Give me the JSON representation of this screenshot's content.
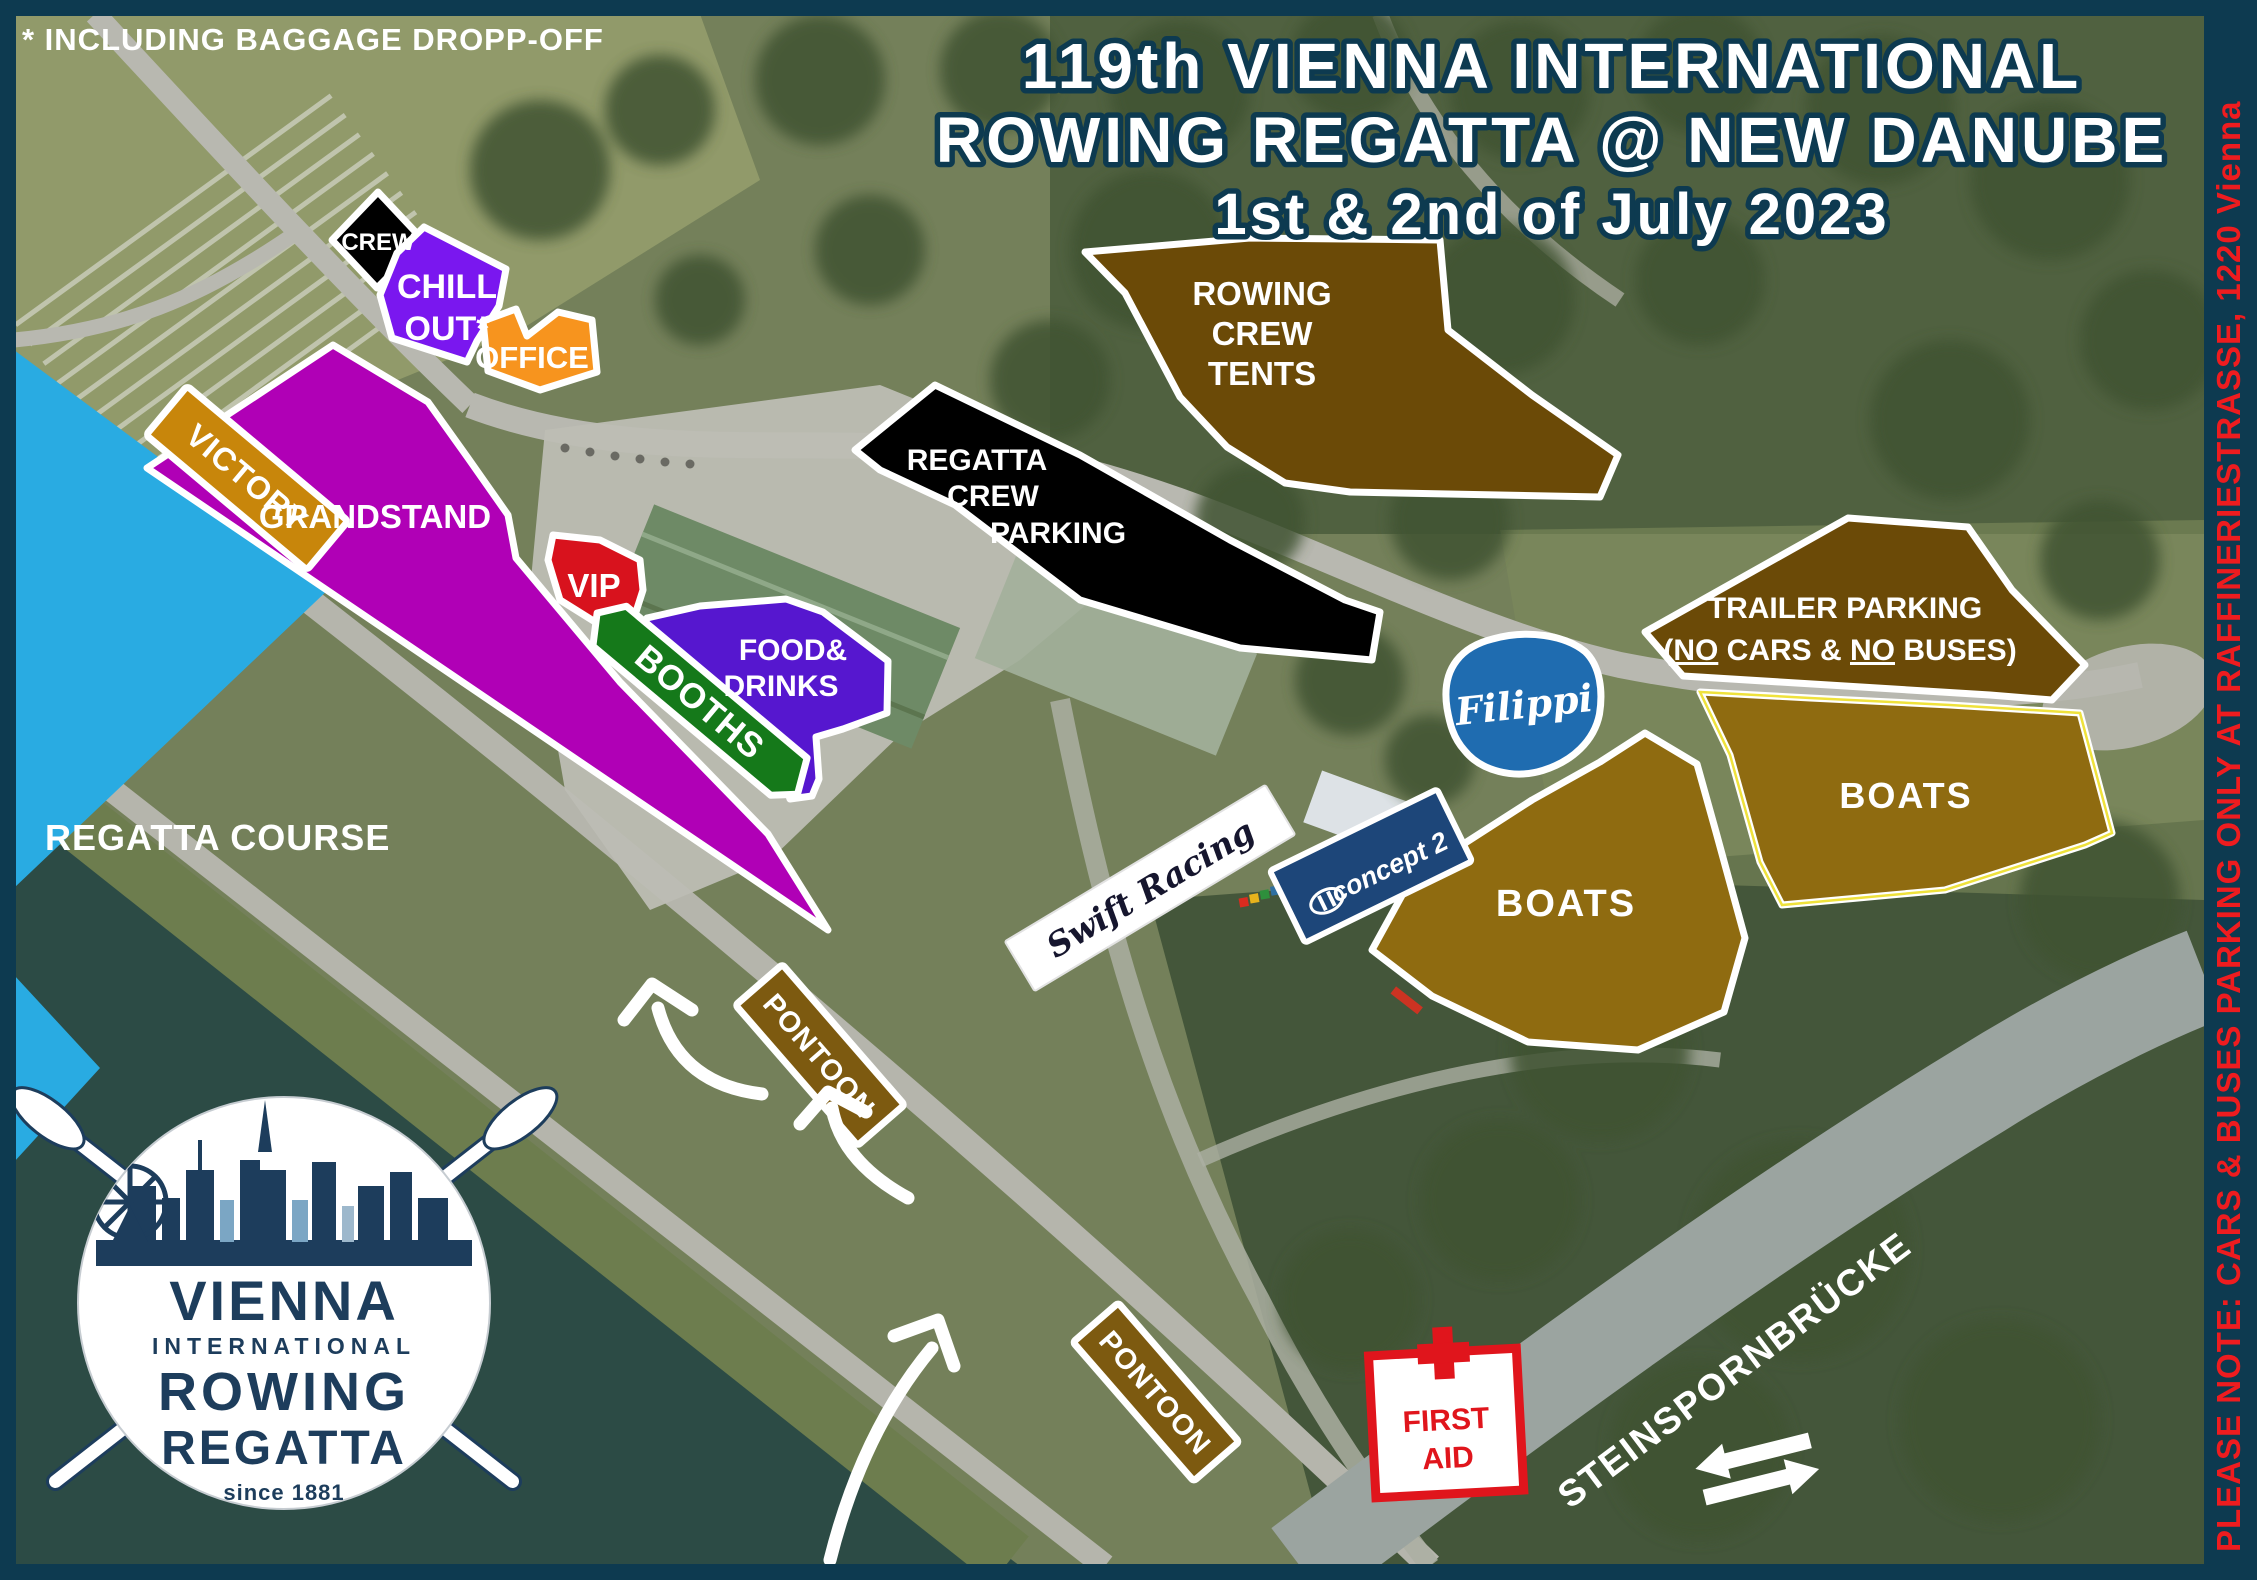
{
  "frame": {
    "color": "#0d3a50"
  },
  "header": {
    "note": "* INCLUDING BAGGAGE DROPP-OFF",
    "title_line1": "119th VIENNA INTERNATIONAL",
    "title_line2": "ROWING REGATTA @ NEW DANUBE",
    "title_line3": "1st & 2nd of July 2023"
  },
  "side_note": {
    "text": "PLEASE NOTE: CARS & BUSES PARKING ONLY AT RAFFINERIESTRASSE, 1220 Vienna",
    "color": "#ee1c1f"
  },
  "zones": {
    "crew": {
      "label": "CREW",
      "color": "#000000"
    },
    "chill_out": {
      "lines": [
        "CHILL",
        "OUT*"
      ],
      "color": "#7a17ef"
    },
    "office": {
      "label": "OFFICE",
      "color": "#f7941e"
    },
    "grandstand": {
      "label": "GRANDSTAND",
      "color": "#b000b6"
    },
    "vip": {
      "label": "VIP",
      "color": "#d8121d"
    },
    "food_drinks": {
      "lines": [
        "FOOD&",
        "DRINKS"
      ],
      "color": "#5617cf"
    },
    "booths": {
      "label": "BOOTHS",
      "color": "#15791a"
    },
    "victory": {
      "label": "VICTORY",
      "color": "#c8860b"
    },
    "regatta_course": {
      "label": "REGATTA COURSE",
      "color": "#29abe2"
    },
    "regatta_crew_parking": {
      "lines": [
        "REGATTA",
        "CREW",
        "PARKING"
      ],
      "color": "#000000"
    },
    "rowing_crew_tents": {
      "lines": [
        "ROWING",
        "CREW",
        "TENTS"
      ],
      "color": "#6b4a07"
    },
    "trailer_parking": {
      "line1": "TRAILER PARKING",
      "parts": [
        "(",
        "NO",
        " CARS & ",
        "NO",
        " BUSES)"
      ],
      "color": "#6b4a07"
    },
    "boats_left": {
      "label": "BOATS",
      "color": "#8f6b10"
    },
    "boats_right": {
      "label": "BOATS",
      "color": "#8f6b10"
    },
    "pontoon_north": {
      "label": "PONTOON",
      "color": "#7d5a10"
    },
    "pontoon_south": {
      "label": "PONTOON",
      "color": "#7d5a10"
    },
    "first_aid": {
      "lines": [
        "FIRST",
        "AID"
      ],
      "color": "#e0151c"
    },
    "bridge": {
      "label": "STEINSPORNBRÜCKE"
    }
  },
  "sponsors": {
    "filippi": {
      "label": "Filippi",
      "color": "#1f6cb0"
    },
    "concept2": {
      "label": "concept 2",
      "color": "#1d4679"
    },
    "swift": {
      "label": "Swift Racing"
    }
  },
  "badge": {
    "line1": "VIENNA",
    "line2": "INTERNATIONAL",
    "line3": "ROWING",
    "line4": "REGATTA",
    "line5": "since 1881",
    "color": "#1d3d5c"
  }
}
